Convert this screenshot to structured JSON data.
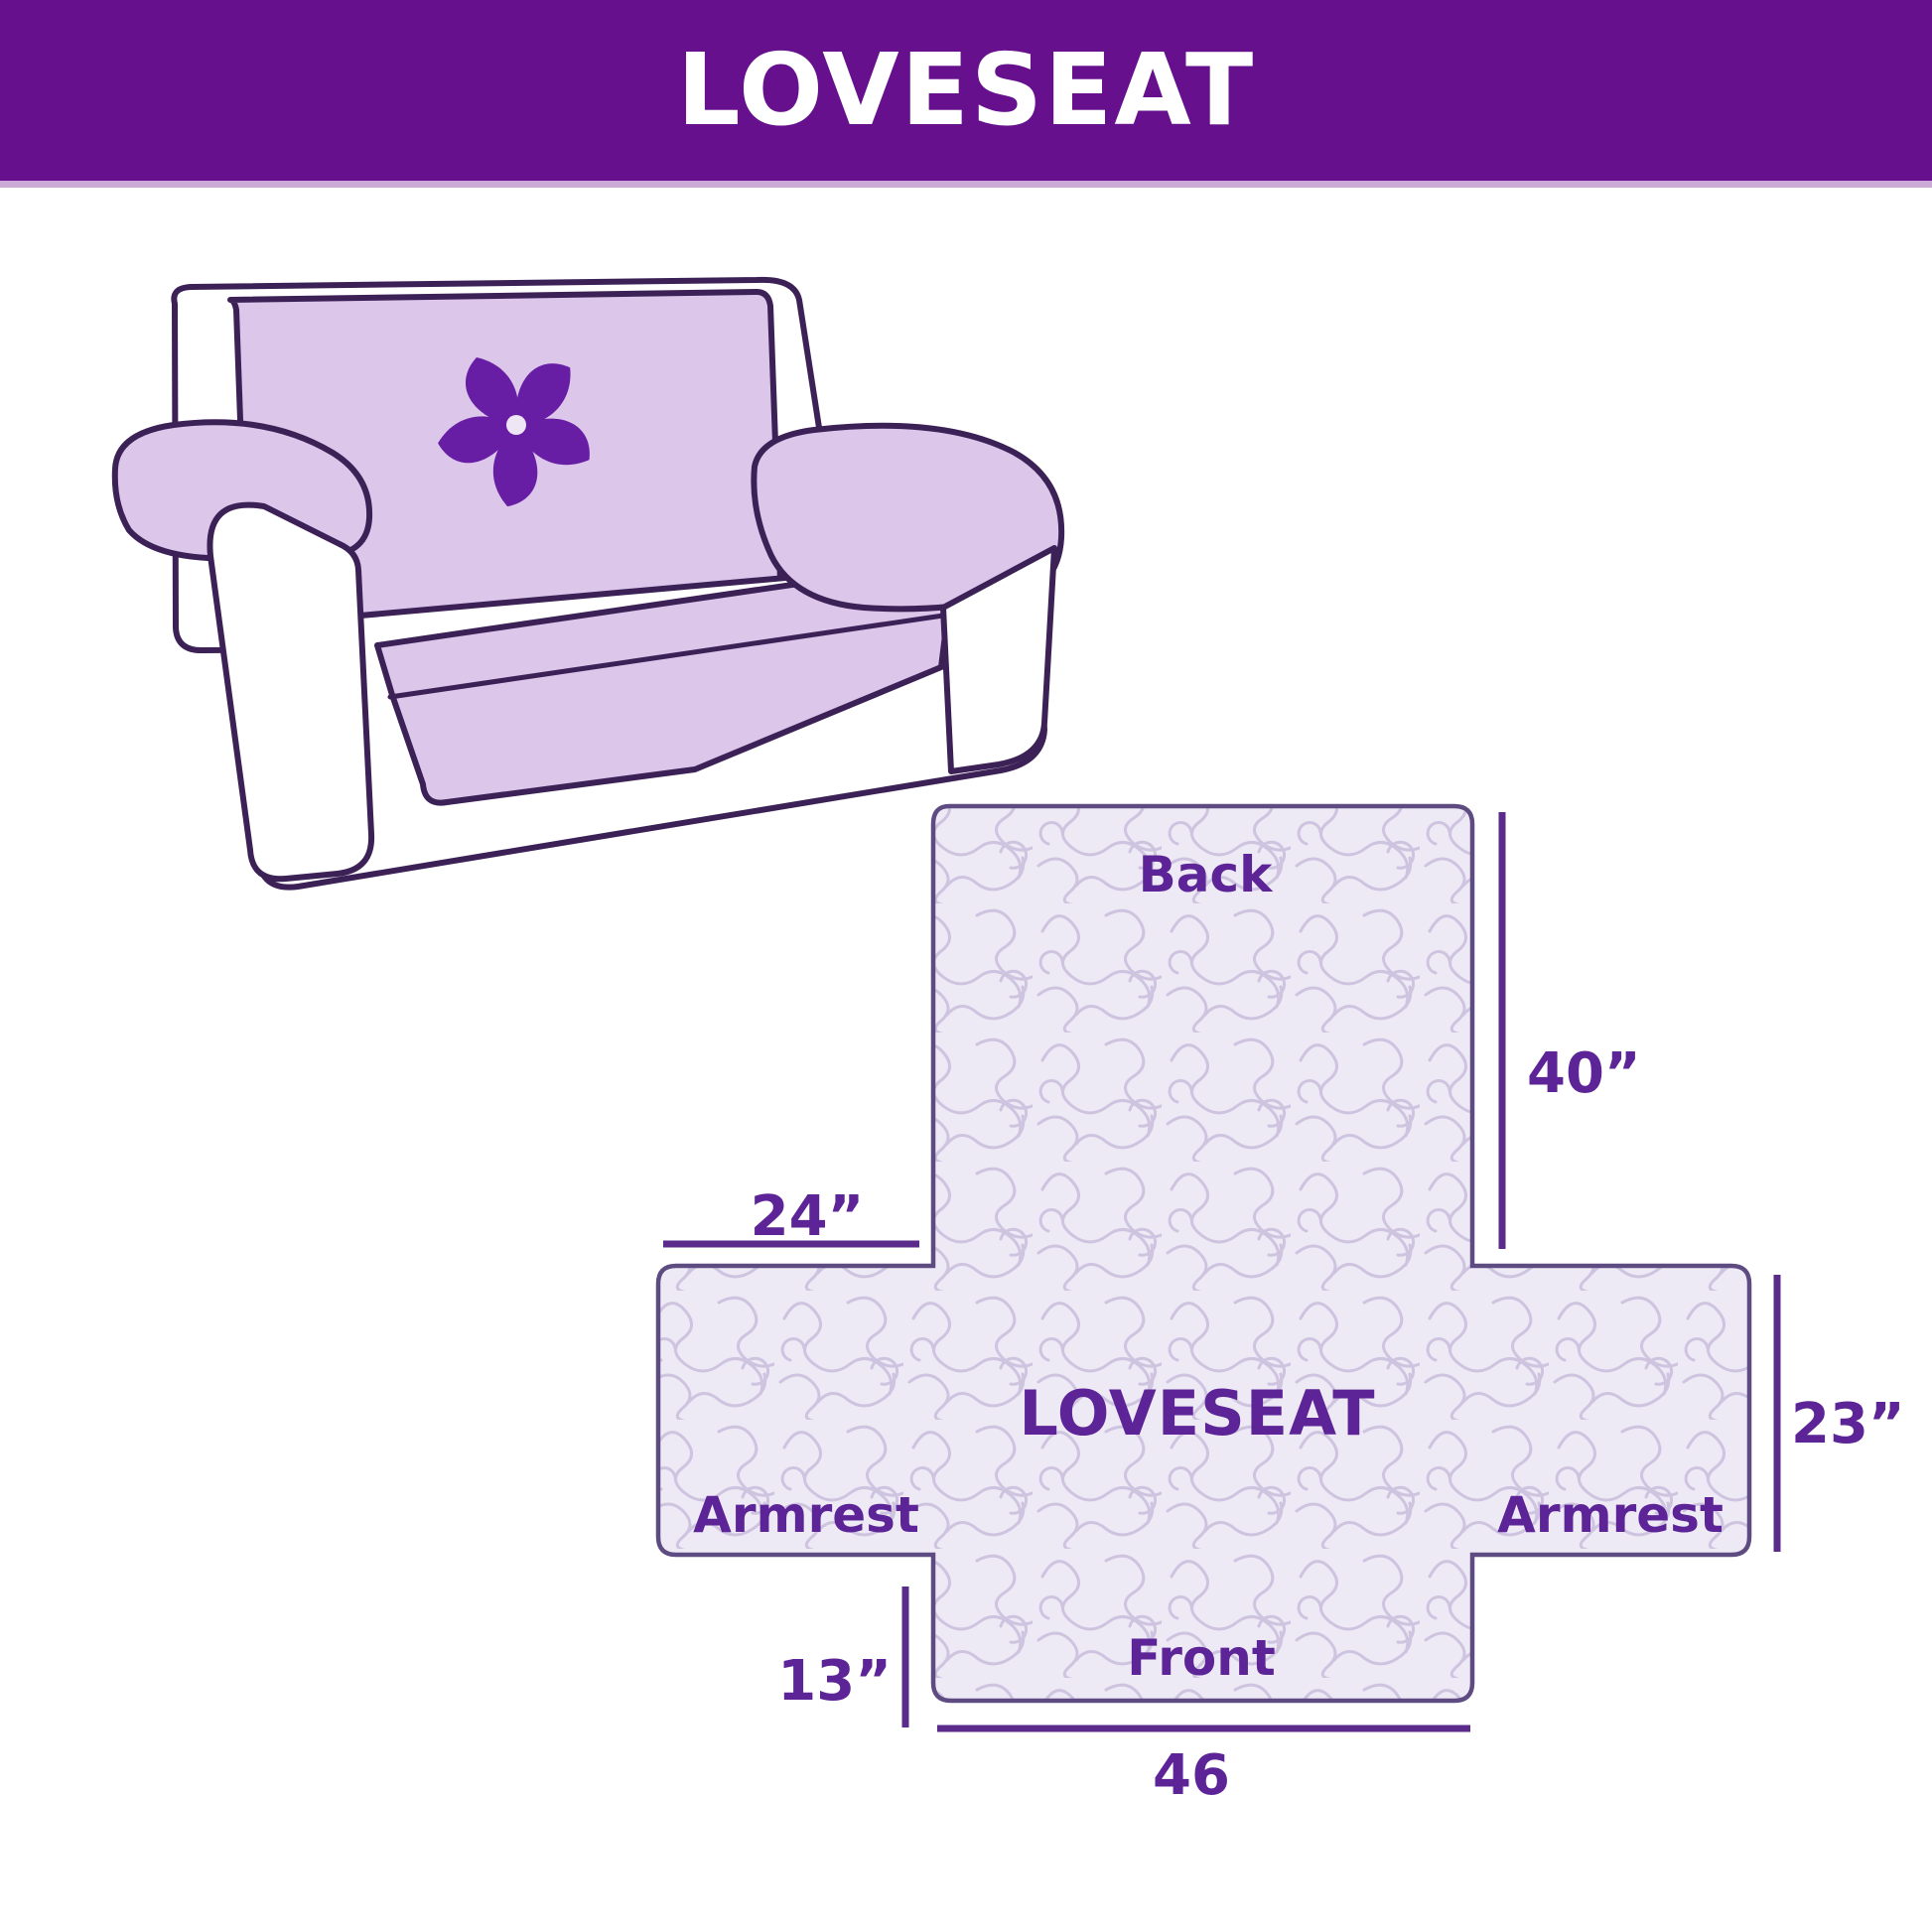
{
  "title_bar": {
    "title": "LOVESEAT"
  },
  "sofa": {
    "description": "loveseat sofa with lavender protective cover",
    "logo_icon": "pinwheel-icon",
    "cover_color": "#dcc6ea",
    "outline_color": "#3c2157",
    "logo_color": "#671da4"
  },
  "diagram": {
    "labels": {
      "back": "Back",
      "center": "LOVESEAT",
      "armrest_left": "Armrest",
      "armrest_right": "Armrest",
      "front": "Front"
    },
    "dims": {
      "back_height": "40”",
      "armrest_width": "24”",
      "side_height": "23”",
      "front_drop": "13”",
      "front_width": "46"
    },
    "colors": {
      "quilt_fill": "#edeaf6",
      "quilt_pattern": "#cfc4e0",
      "shape_outline": "#5e4b82",
      "dimension_line": "#5a2b8a",
      "label_text": "#5c2496",
      "header_purple": "#66108e",
      "header_divider": "#cbaad8"
    }
  }
}
